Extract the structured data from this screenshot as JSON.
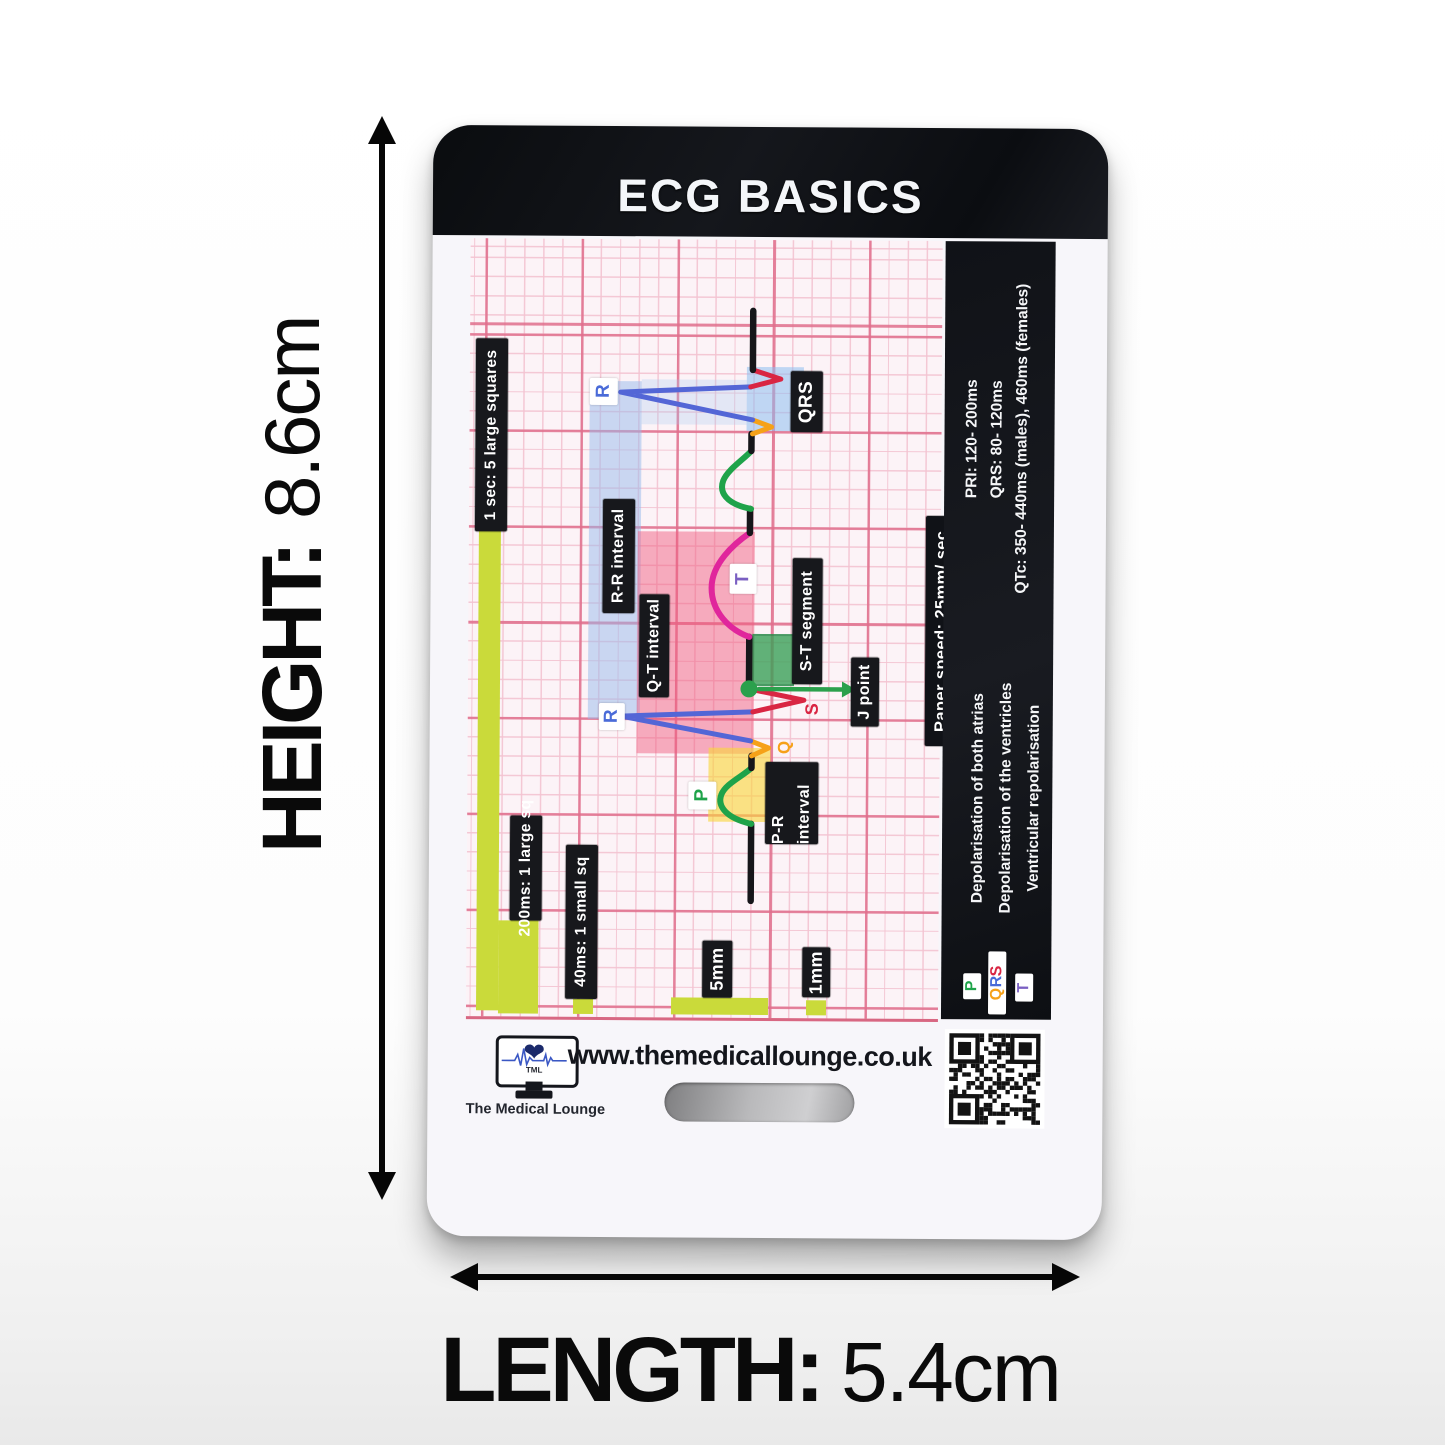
{
  "product_card": {
    "title": "ECG BASICS",
    "website": "www.themedicallounge.co.uk",
    "brand": {
      "monitor_text": "TML",
      "name": "The Medical Lounge"
    }
  },
  "dimension_annotations": {
    "height": {
      "label": "HEIGHT:",
      "value": "8.6cm"
    },
    "length": {
      "label": "LENGTH:",
      "value": "5.4cm"
    }
  },
  "ecg_diagram": {
    "scale_labels": {
      "one_second": "1 sec: 5 large squares",
      "large_square_time": "200ms: 1 large sq",
      "small_square_time": "40ms: 1 small sq",
      "large_square_size": "5mm",
      "small_square_size": "1mm"
    },
    "interval_labels": {
      "rr": "R-R interval",
      "qt": "Q-T interval",
      "pr": "P-R interval",
      "st": "S-T segment",
      "j_point": "J point",
      "qrs": "QRS"
    },
    "wave_letters": {
      "p": "P",
      "q": "Q",
      "r": "R",
      "s": "S",
      "t": "T"
    },
    "colors": {
      "p_wave": "#1fa34a",
      "q_wave": "#f6a118",
      "r_wave": "#5366d6",
      "s_wave": "#d92643",
      "t_wave": "#e0269c",
      "t_letter": "#7a5fc2",
      "grid_bold": "#e06e8c",
      "grid_thin": "#f3c3d1",
      "highlight_blue": "#9fc1ea",
      "highlight_pink": "#f05a7d",
      "highlight_yellow": "#f8d53c",
      "highlight_green": "#3aa058",
      "scale_bar": "#cada3a"
    }
  },
  "info_panel": {
    "paper_speed": "Paper speed: 25mm/ sec",
    "reference_values": [
      "PRI: 120- 200ms",
      "QRS: 80- 120ms",
      "QTc: 350- 440ms (males), 460ms (females)"
    ],
    "wave_meanings": [
      "Depolarisation of both atrias",
      "Depolarisation of the ventricles",
      "Ventricular repolarisation"
    ],
    "legend": {
      "p": "P",
      "q": "Q",
      "r": "R",
      "s": "S",
      "t": "T"
    }
  }
}
